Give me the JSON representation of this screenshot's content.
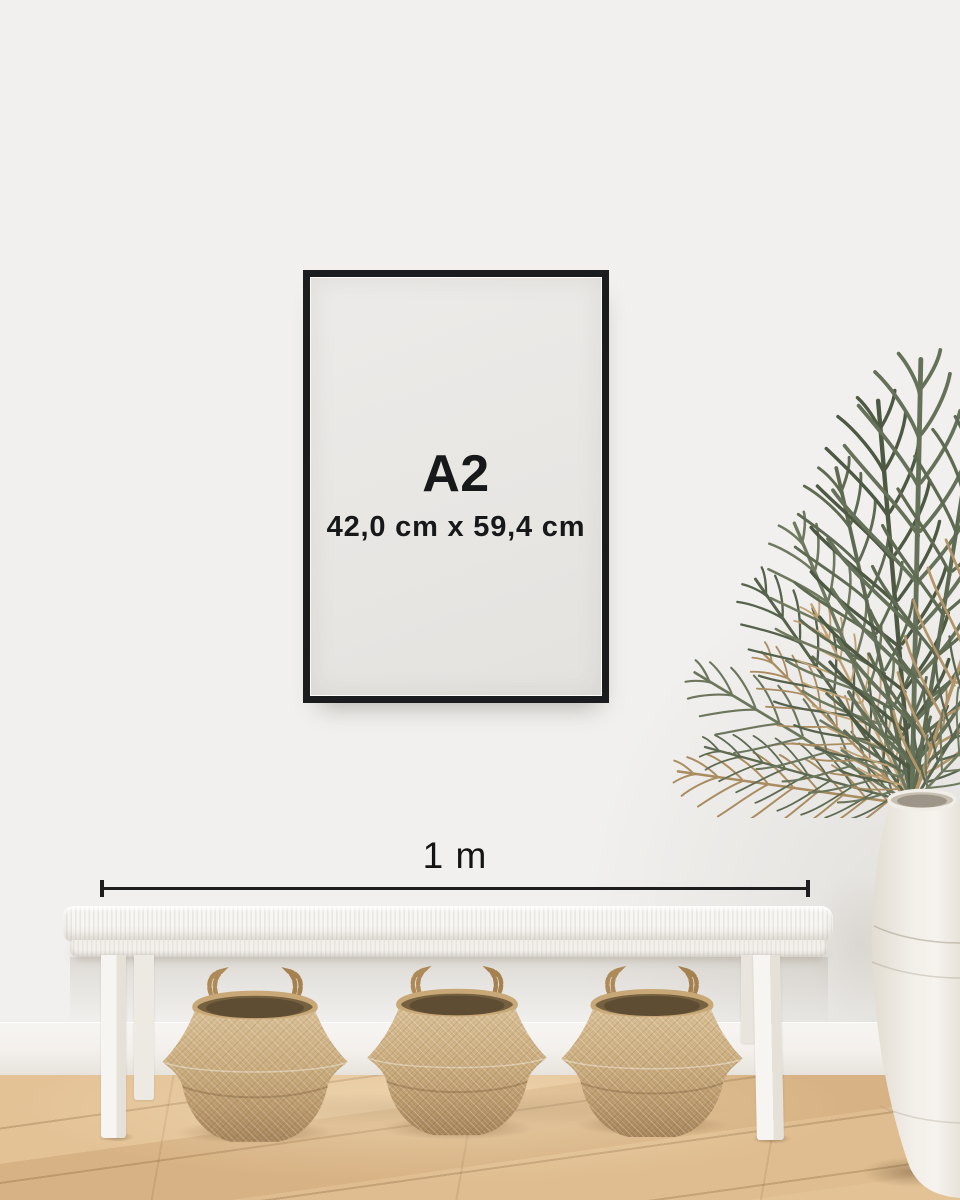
{
  "poster": {
    "size_label": "A2",
    "dimensions_label": "42,0 cm x 59,4 cm"
  },
  "measurement": {
    "label": "1 m"
  },
  "palette": {
    "wall": "#f1f0ee",
    "frame": "#1a1c1e",
    "poster_paper": "#e9e7e4",
    "text": "#17181a",
    "dimension_line": "#1e1e1e",
    "bench_white": "#f6f4f0",
    "basket_tan": "#c9ab7c",
    "basket_interior": "#6b5a42",
    "plant_green": "#5e6a51",
    "plant_dried": "#ab8d63",
    "vase_white": "#f2efe9",
    "baseboard": "#f5f3ef",
    "floor_wood": "#ddbb8d"
  }
}
